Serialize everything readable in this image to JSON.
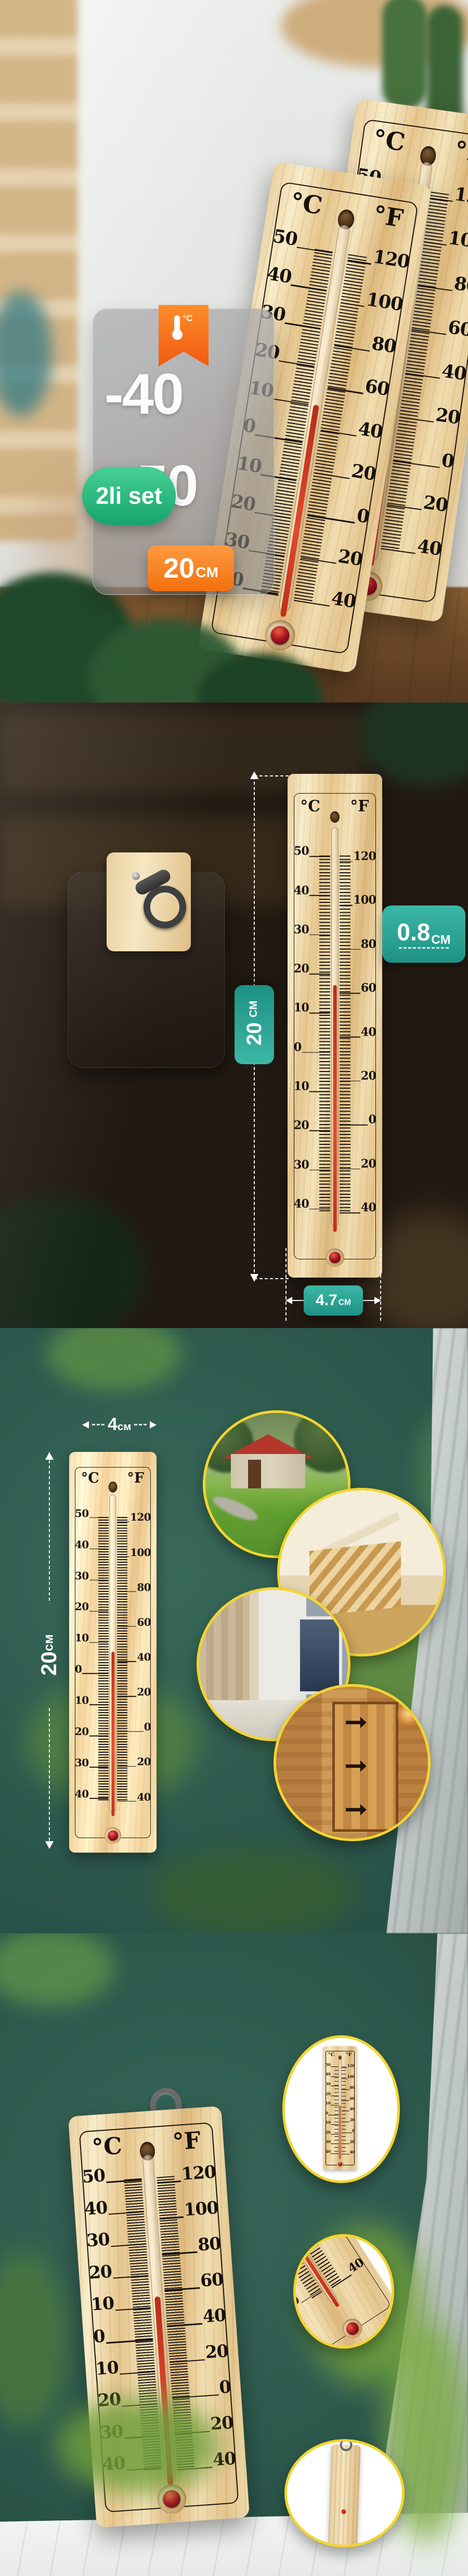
{
  "units": {
    "celsius": "°C",
    "fahrenheit": "°F"
  },
  "thermometer_scale": {
    "c_labels": [
      "50",
      "40",
      "30",
      "20",
      "10",
      "0",
      "10",
      "20",
      "30",
      "40"
    ],
    "f_labels": [
      "120",
      "100",
      "80",
      "60",
      "40",
      "20",
      "0",
      "20",
      "40"
    ]
  },
  "panel1": {
    "range_badge": {
      "low": "-40",
      "high": "+50",
      "ribbon_unit": "°C"
    },
    "set_badge": "2li set",
    "size_badge": {
      "value": "20",
      "unit": "CM"
    }
  },
  "panel2": {
    "height_badge": {
      "value": "20",
      "unit": "CM"
    },
    "thickness_badge": {
      "value": "0.8",
      "unit": "CM"
    },
    "width_badge": {
      "value": "4.7",
      "unit": "CM"
    }
  },
  "panel3": {
    "width_label": {
      "value": "4",
      "unit": "см"
    },
    "height_label": {
      "value": "20",
      "unit": "см"
    }
  },
  "colors": {
    "teal_badge": "#2aa093",
    "green_badge": "#2ebd85",
    "orange_badge": "#f2700f",
    "accent_yellow": "#f3d42c",
    "wood_light": "#f2e0b8",
    "mercury_red": "#d63a1e",
    "background_teal": "#2e5a4e"
  }
}
